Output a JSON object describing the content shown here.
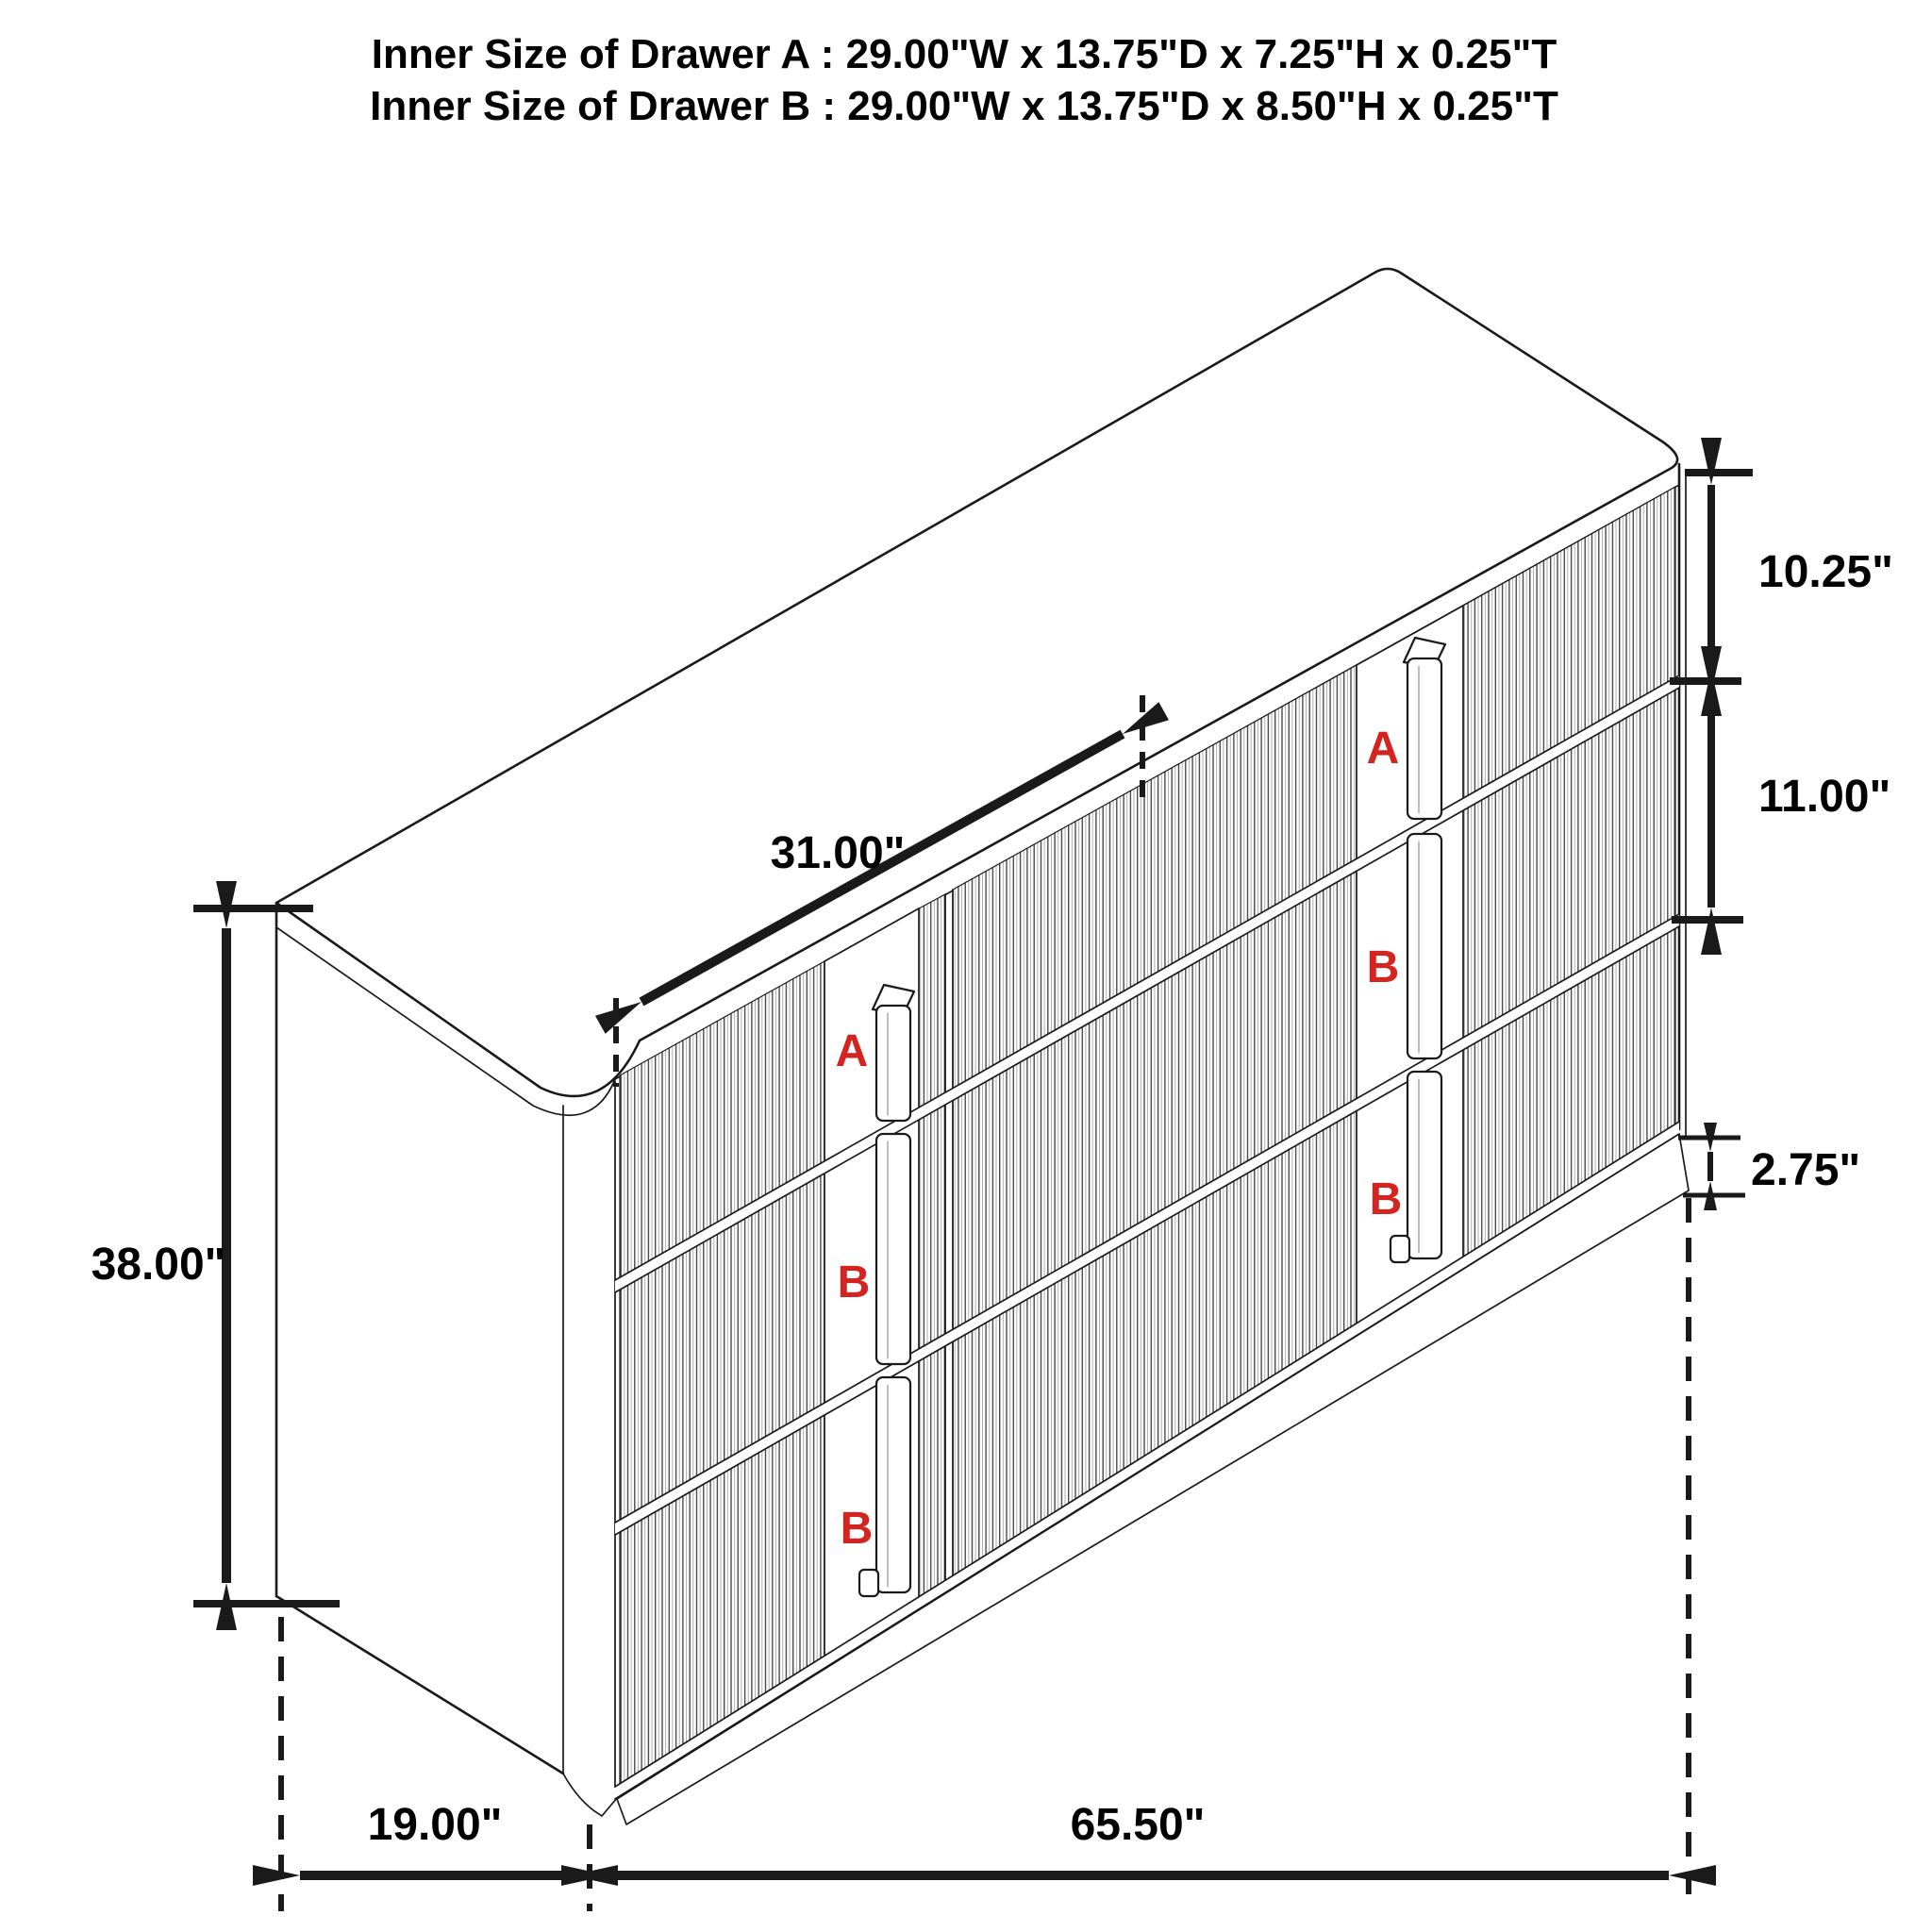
{
  "title": {
    "line1": "Inner Size of Drawer A : 29.00\"W x 13.75\"D x 7.25\"H x 0.25\"T",
    "line2": "Inner Size of Drawer B : 29.00\"W x 13.75\"D x 8.50\"H x 0.25\"T"
  },
  "dimensions": {
    "height": "38.00\"",
    "depth": "19.00\"",
    "width": "65.50\"",
    "top_edge": "31.00\"",
    "top_drawer_height": "10.25\"",
    "middle_drawer_height": "11.00\"",
    "base_height": "2.75\""
  },
  "drawer_labels": {
    "left": [
      "A",
      "B",
      "B"
    ],
    "right": [
      "A",
      "B",
      "B"
    ]
  },
  "colors": {
    "line": "#1a1a1a",
    "drawer_label": "#d42420",
    "background": "#ffffff"
  }
}
